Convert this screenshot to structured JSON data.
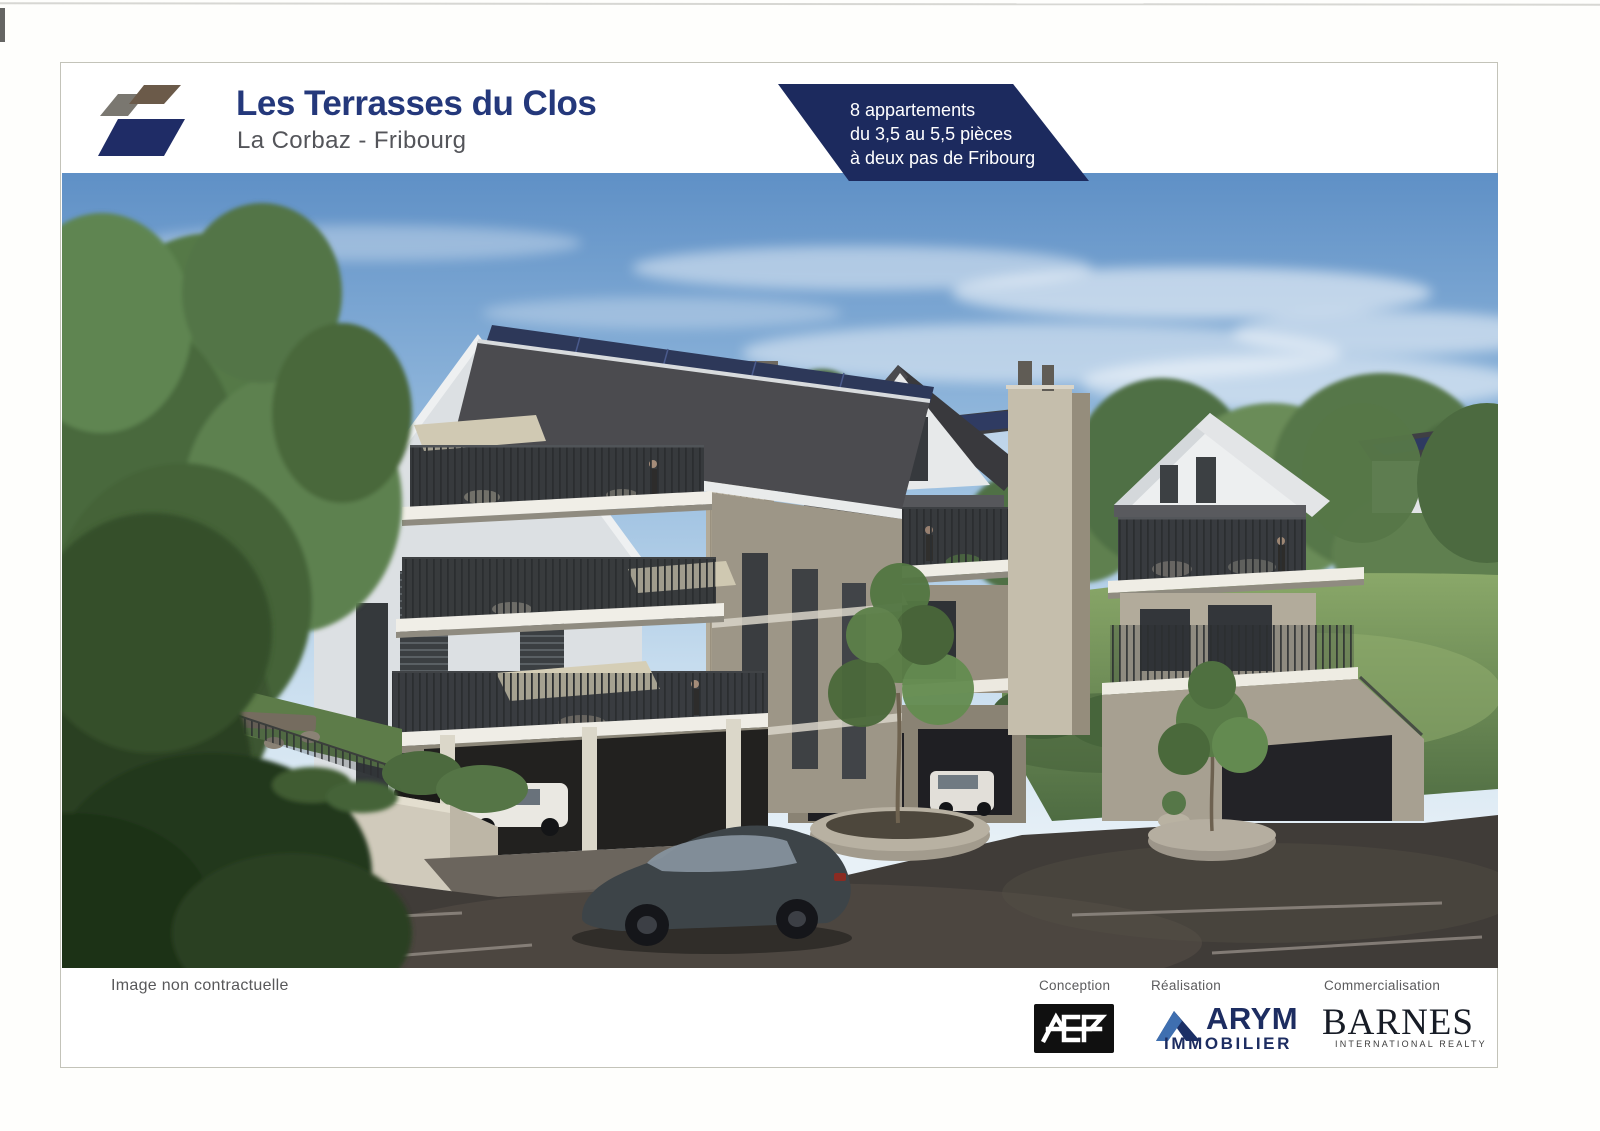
{
  "header": {
    "title": "Les Terrasses du Clos",
    "subtitle": "La Corbaz - Fribourg",
    "logo": {
      "gray": "#7a7770",
      "brown": "#6b5a49",
      "navy": "#1f2c66"
    },
    "badge": {
      "line1": "8 appartements",
      "line2": "du 3,5 au 5,5 pièces",
      "line3": "à deux pas de Fribourg",
      "background": "#1c2a5e",
      "text_color": "#ffffff"
    }
  },
  "rendering": {
    "description": "Architectural rendering of three modern gabled apartment buildings with terraces, balconies, covered parking, a dark sedan, trees and lawn",
    "sky_color": "#5f90c6",
    "roof_color": "#4b4b4f",
    "solar_panel_color": "#2d3859"
  },
  "footer": {
    "caption": "Image non contractuelle",
    "partners": [
      {
        "role": "Conception",
        "name": "ACP"
      },
      {
        "role": "Réalisation",
        "name": "ARYM",
        "subname": "IMMOBILIER",
        "color": "#1d2d61"
      },
      {
        "role": "Commercialisation",
        "name": "BARNES",
        "subname": "INTERNATIONAL REALTY",
        "color": "#171c26"
      }
    ]
  }
}
